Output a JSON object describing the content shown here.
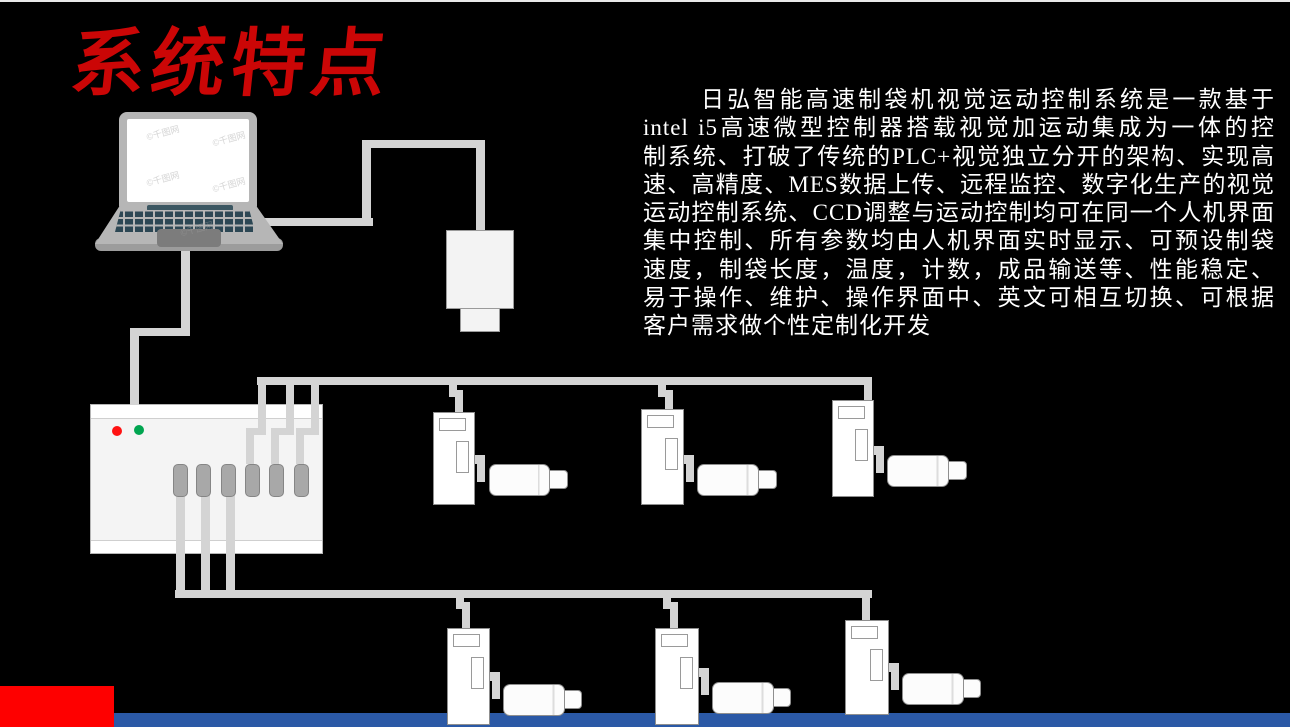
{
  "page": {
    "title": "系统特点",
    "colors": {
      "background": "#000000",
      "title_red": "#CB0606",
      "accent_block_red": "#FE0000",
      "footer_bar_blue": "#2B59A6",
      "cable_gray": "#D4D4D4",
      "led_red": "#FF1212",
      "led_green": "#00A550",
      "device_white": "#FFFFFF",
      "laptop_gray": "#B6B6B6",
      "keyboard_dark": "#2C4754"
    }
  },
  "description": {
    "lines": [
      "日弘智能高速制袋机视觉运动控制系统是一款基于",
      "intel i5高速微型控制器搭载视觉加运动集成为一体的控",
      "制系统、打破了传统的PLC+视觉独立分开的架构、实现高",
      "速、高精度、MES数据上传、远程监控、数字化生产的视觉",
      "运动控制系统、CCD调整与运动控制均可在同一个人机界面",
      "集中控制、所有参数均由人机界面实时显示、可预设制袋",
      "速度，制袋长度，温度，计数，成品输送等、性能稳定、",
      "易于操作、维护、操作界面中、英文可相互切换、可根据",
      "客户需求做个性定制化开发"
    ]
  },
  "watermark": {
    "text": "©千图网"
  }
}
